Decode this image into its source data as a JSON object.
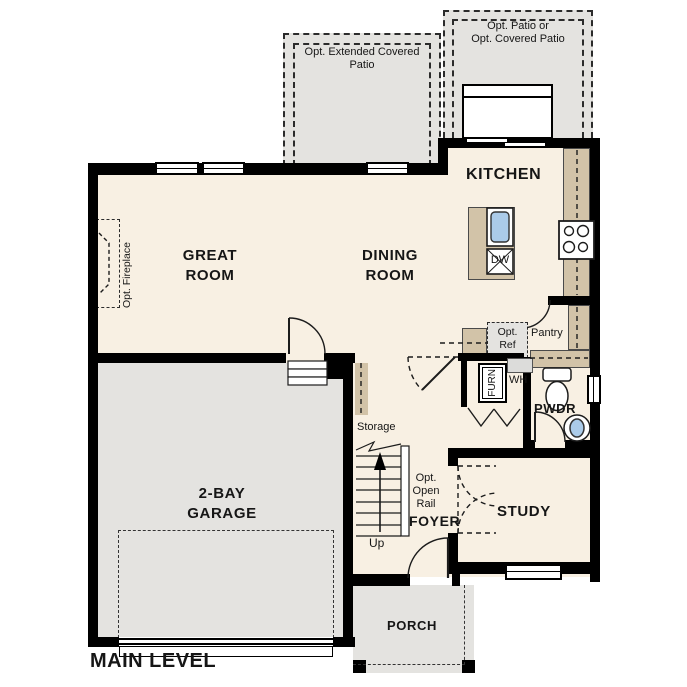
{
  "colors": {
    "wall": "#000000",
    "floor": "#f8f0e3",
    "exterior": "#e4e3e0",
    "cabinet": "#d2c3a8",
    "fixture_blue": "#abcbe9"
  },
  "title": "MAIN LEVEL",
  "labels": {
    "main_level": "MAIN LEVEL",
    "great_room": "GREAT\nROOM",
    "dining_room": "DINING\nROOM",
    "kitchen": "KITCHEN",
    "garage": "2-BAY\nGARAGE",
    "study": "STUDY",
    "foyer": "FOYER",
    "pwdr": "PWDR",
    "porch": "PORCH",
    "pantry": "Pantry",
    "storage": "Storage",
    "up": "Up",
    "furn": "FURN",
    "wh": "WH",
    "dw": "DW",
    "opt_ref": "Opt.\nRef",
    "opt_open_rail": "Opt.\nOpen\nRail",
    "opt_fireplace": "Opt. Fireplace",
    "patio_covered": "Opt. Patio or\nOpt. Covered Patio",
    "patio_extended": "Opt. Extended Covered\nPatio"
  }
}
